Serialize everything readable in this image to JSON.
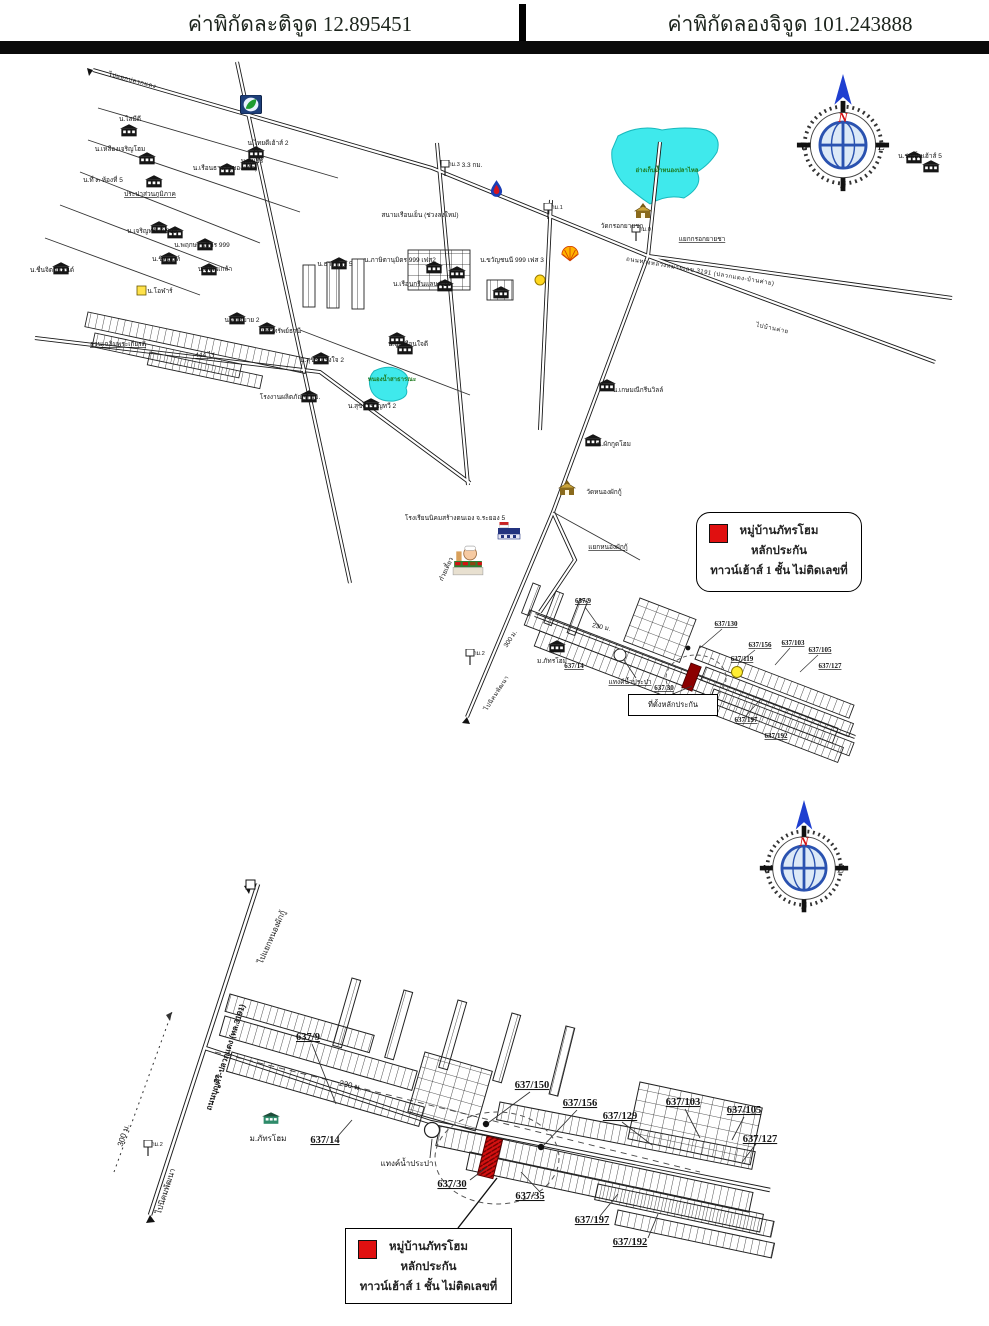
{
  "header": {
    "latitude": "ค่าพิกัดละติจูด 12.895451",
    "longitude": "ค่าพิกัดลองจิจูด 101.243888"
  },
  "colors": {
    "pond": "#3fe9ec",
    "pond_label": "#1d7a1d",
    "marker_red": "#e01010",
    "subject_red": "#8b0000",
    "compass_blue": "#2a52b0",
    "arrow_blue": "#1f3fd0"
  },
  "compass": {
    "n": "N",
    "e": "E",
    "s": "S",
    "w": "W"
  },
  "legend": {
    "line1": "หมู่บ้านภัทรโฮม",
    "line2": "หลักประกัน",
    "line3": "ทาวน์เฮ้าส์ 1 ชั้น ไม่ติดเลขที่"
  },
  "map1": {
    "collateral_box": "ที่ตั้งหลักประกัน",
    "labels": [
      {
        "text": "ไปแยกปลวกแดง",
        "x": 132,
        "y": 82,
        "rot": 15,
        "cls": "road"
      },
      {
        "text": "น.ไสมีดี",
        "x": 130,
        "y": 121
      },
      {
        "text": "น.เหลืองเจริญโฮม",
        "x": 120,
        "y": 151
      },
      {
        "text": "น.เรือนธารา (ของแก้ว)",
        "x": 225,
        "y": 170
      },
      {
        "text": "น.ไทยดีเฮ้าส์ 2",
        "x": 268,
        "y": 145
      },
      {
        "text": "น.คันธีร์",
        "x": 252,
        "y": 163
      },
      {
        "text": "น.ที่ ๓ ห้องที่ 5",
        "x": 103,
        "y": 182
      },
      {
        "text": "ประปาส่วนภูมิภาค",
        "x": 150,
        "y": 196,
        "cls": "u"
      },
      {
        "text": "น.เจริญทรัพย์ 999",
        "x": 152,
        "y": 233
      },
      {
        "text": "น.พฤกษานุมิตร 999",
        "x": 202,
        "y": 247
      },
      {
        "text": "น.ชิตนนท์",
        "x": 166,
        "y": 261
      },
      {
        "text": "น.ชื่นจิตต์แลนด์",
        "x": 52,
        "y": 272
      },
      {
        "text": "น.โอฬาร์",
        "x": 160,
        "y": 293
      },
      {
        "text": "น.ตฤณเกล้า",
        "x": 215,
        "y": 271
      },
      {
        "text": "น.อยู่สบาย 2",
        "x": 242,
        "y": 322
      },
      {
        "text": "สวนเฉลิมพระเกียรติ",
        "x": 118,
        "y": 346,
        "cls": "u"
      },
      {
        "text": "444 ไร่",
        "x": 205,
        "y": 357,
        "cls": "u"
      },
      {
        "text": "น.ธารทิพย์ 5",
        "x": 335,
        "y": 266
      },
      {
        "text": "น.ทวีทรัพย์ธานี",
        "x": 280,
        "y": 333
      },
      {
        "text": "น.ปูนเรือนใจดี",
        "x": 408,
        "y": 346
      },
      {
        "text": "น.สุขีรื่นเริงใจ 2",
        "x": 322,
        "y": 362
      },
      {
        "text": "โรงงานผลิตภัณฑ์ ออ.",
        "x": 290,
        "y": 399
      },
      {
        "text": "น.สุขสำราญทวี 2",
        "x": 372,
        "y": 408
      },
      {
        "text": "สนามเรือนเย็น (ช่วงลงใหม่)",
        "x": 420,
        "y": 217
      },
      {
        "text": "3.3 กม.",
        "x": 472,
        "y": 167
      },
      {
        "text": "น.ภาษิตานุมิตร 999 เฟส2",
        "x": 400,
        "y": 262
      },
      {
        "text": "น.ขวัญชนนี 999 เฟส 3",
        "x": 512,
        "y": 262
      },
      {
        "text": "น.เรือนกรีนแลนด์ 10",
        "x": 422,
        "y": 286
      },
      {
        "text": "ถนนทางหลวงหมายเลข 3191 (ปลวกแดง-บ้านค่าย)",
        "x": 700,
        "y": 273,
        "rot": 9.5,
        "cls": "road"
      },
      {
        "text": "อ่างเก็บน้ำหนองปลาไหล",
        "x": 667,
        "y": 172,
        "cls": "pond"
      },
      {
        "text": "วัดกรอกยายชา",
        "x": 622,
        "y": 228
      },
      {
        "text": "แยกกรอกยายชา",
        "x": 702,
        "y": 241,
        "cls": "u"
      },
      {
        "text": "ไปบ้านค่าย",
        "x": 772,
        "y": 330,
        "rot": 12,
        "cls": "road"
      },
      {
        "text": "น.ร่มเย็นเฮ้าส์ 5",
        "x": 920,
        "y": 158
      },
      {
        "text": "น.เกษมณีกรีนวิลล์",
        "x": 638,
        "y": 392
      },
      {
        "text": "น.ผักกูดโฮม",
        "x": 614,
        "y": 446
      },
      {
        "text": "วัดหนองผักกู้",
        "x": 604,
        "y": 494
      },
      {
        "text": "โรงเรียนนิคมสร้างตนเอง จ.ระยอง 5",
        "x": 455,
        "y": 520
      },
      {
        "text": "แยกหนองผักกู้",
        "x": 608,
        "y": 549,
        "cls": "u"
      },
      {
        "text": "ก๋วยเตี๋ยว",
        "x": 448,
        "y": 570,
        "rot": -65
      },
      {
        "text": "ไปนิคมพัฒนา",
        "x": 498,
        "y": 694,
        "rot": -57,
        "cls": "road"
      },
      {
        "text": "300 ม.",
        "x": 512,
        "y": 640,
        "rot": -57
      },
      {
        "text": "ม.ภัทรโฮม",
        "x": 552,
        "y": 663
      },
      {
        "text": "637/9",
        "x": 583,
        "y": 603,
        "cls": "num1"
      },
      {
        "text": "230 ม.",
        "x": 601,
        "y": 629,
        "rot": 12
      },
      {
        "text": "637/14",
        "x": 574,
        "y": 668,
        "cls": "num1"
      },
      {
        "text": "แทงค์น้ำประปา",
        "x": 630,
        "y": 684,
        "cls": "u"
      },
      {
        "text": "637/130",
        "x": 726,
        "y": 626,
        "cls": "num1"
      },
      {
        "text": "637/156",
        "x": 760,
        "y": 647,
        "cls": "num1"
      },
      {
        "text": "637/119",
        "x": 742,
        "y": 661,
        "cls": "num1"
      },
      {
        "text": "637/103",
        "x": 793,
        "y": 645,
        "cls": "num1"
      },
      {
        "text": "637/105",
        "x": 820,
        "y": 652,
        "cls": "num1"
      },
      {
        "text": "637/127",
        "x": 830,
        "y": 668,
        "cls": "num1"
      },
      {
        "text": "637/30",
        "x": 664,
        "y": 690,
        "cls": "num1"
      },
      {
        "text": "637/35",
        "x": 702,
        "y": 701,
        "cls": "num1"
      },
      {
        "text": "637/197",
        "x": 746,
        "y": 722,
        "cls": "num1"
      },
      {
        "text": "637/192",
        "x": 776,
        "y": 738,
        "cls": "num1"
      },
      {
        "text": "หนองน้ำสาธารณะ",
        "x": 392,
        "y": 381,
        "cls": "pond"
      }
    ],
    "signs": [
      {
        "x": 440,
        "y": 160,
        "text": "กม.3"
      },
      {
        "x": 543,
        "y": 203,
        "text": "กม.1"
      },
      {
        "x": 631,
        "y": 225,
        "text": "กม.0"
      },
      {
        "x": 465,
        "y": 649,
        "text": "กม.2"
      }
    ],
    "buildings": [
      [
        120,
        124
      ],
      [
        138,
        152
      ],
      [
        218,
        163
      ],
      [
        247,
        146
      ],
      [
        240,
        158
      ],
      [
        145,
        175
      ],
      [
        150,
        221
      ],
      [
        166,
        226
      ],
      [
        196,
        238
      ],
      [
        160,
        252
      ],
      [
        52,
        262
      ],
      [
        200,
        263
      ],
      [
        228,
        312
      ],
      [
        258,
        322
      ],
      [
        330,
        257
      ],
      [
        388,
        332
      ],
      [
        396,
        342
      ],
      [
        312,
        352
      ],
      [
        300,
        390
      ],
      [
        362,
        398
      ],
      [
        425,
        261
      ],
      [
        448,
        266
      ],
      [
        436,
        279
      ],
      [
        492,
        286
      ],
      [
        598,
        379
      ],
      [
        584,
        434
      ],
      [
        905,
        151
      ],
      [
        922,
        160
      ],
      [
        548,
        640
      ]
    ]
  },
  "map2": {
    "labels": [
      {
        "text": "ถนนบุญศิริ-ปลวกแดง (ทล.3191)",
        "x": 228,
        "y": 1058,
        "rot": -72,
        "cls": "road9"
      },
      {
        "text": "ไปแยกหนองผักกู้",
        "x": 274,
        "y": 938,
        "rot": -66,
        "cls": "big9"
      },
      {
        "text": "ไปนิคมพัฒนา",
        "x": 168,
        "y": 1192,
        "rot": -72,
        "cls": "big9"
      },
      {
        "text": "300 ม.",
        "x": 126,
        "y": 1136,
        "rot": -72,
        "cls": "big9"
      },
      {
        "text": "637/9",
        "x": 308,
        "y": 1040,
        "cls": "num"
      },
      {
        "text": "230 ม.",
        "x": 350,
        "y": 1088,
        "rot": 13,
        "cls": "big9"
      },
      {
        "text": "ม.ภัทรโฮม",
        "x": 268,
        "y": 1141,
        "cls": "big9"
      },
      {
        "text": "637/14",
        "x": 325,
        "y": 1143,
        "cls": "num"
      },
      {
        "text": "แทงค์น้ำประปา",
        "x": 407,
        "y": 1166,
        "cls": "big9"
      },
      {
        "text": "637/150",
        "x": 532,
        "y": 1088,
        "cls": "num"
      },
      {
        "text": "637/156",
        "x": 580,
        "y": 1106,
        "cls": "num"
      },
      {
        "text": "637/129",
        "x": 620,
        "y": 1119,
        "cls": "num"
      },
      {
        "text": "637/103",
        "x": 683,
        "y": 1105,
        "cls": "num"
      },
      {
        "text": "637/105",
        "x": 744,
        "y": 1113,
        "cls": "num"
      },
      {
        "text": "637/127",
        "x": 760,
        "y": 1142,
        "cls": "num"
      },
      {
        "text": "637/30",
        "x": 452,
        "y": 1187,
        "cls": "num"
      },
      {
        "text": "637/35",
        "x": 530,
        "y": 1199,
        "cls": "num"
      },
      {
        "text": "637/197",
        "x": 592,
        "y": 1223,
        "cls": "num"
      },
      {
        "text": "637/192",
        "x": 630,
        "y": 1245,
        "cls": "num"
      }
    ],
    "signs": [
      {
        "x": 143,
        "y": 1140,
        "text": "กม.2"
      }
    ],
    "buildings": [
      [
        262,
        1112
      ]
    ]
  }
}
